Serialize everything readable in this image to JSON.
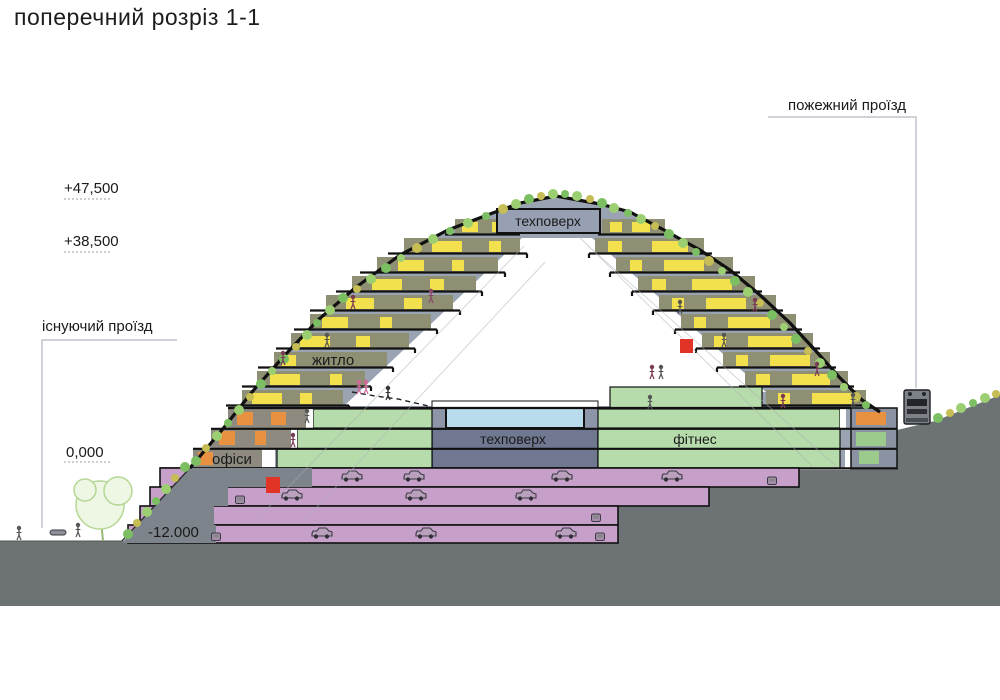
{
  "title": "поперечний розріз 1-1",
  "annotations": {
    "fire_road": "пожежний проїзд",
    "existing_road": "існуючий проїзд"
  },
  "elevations": {
    "crown": "+47,500",
    "upper": "+38,500",
    "ground": "0,000",
    "lowest": "-12.000"
  },
  "zones": {
    "tech_top": "техповерх",
    "tech_mid": "техповерх",
    "housing": "житло",
    "fitness": "фітнес",
    "offices": "офіси"
  },
  "colors": {
    "terrace_band": "#8f8f73",
    "window_yellow": "#f2e14c",
    "green_floor": "#b7dcab",
    "parking_pink": "#c7a0c9",
    "pool_blue": "#b9dcec",
    "slate": "#9aa3b2",
    "tech_slate": "#6f7890",
    "ground_gray": "#6d7375",
    "accent_orange": "#e89140",
    "accent_red": "#e13426"
  }
}
